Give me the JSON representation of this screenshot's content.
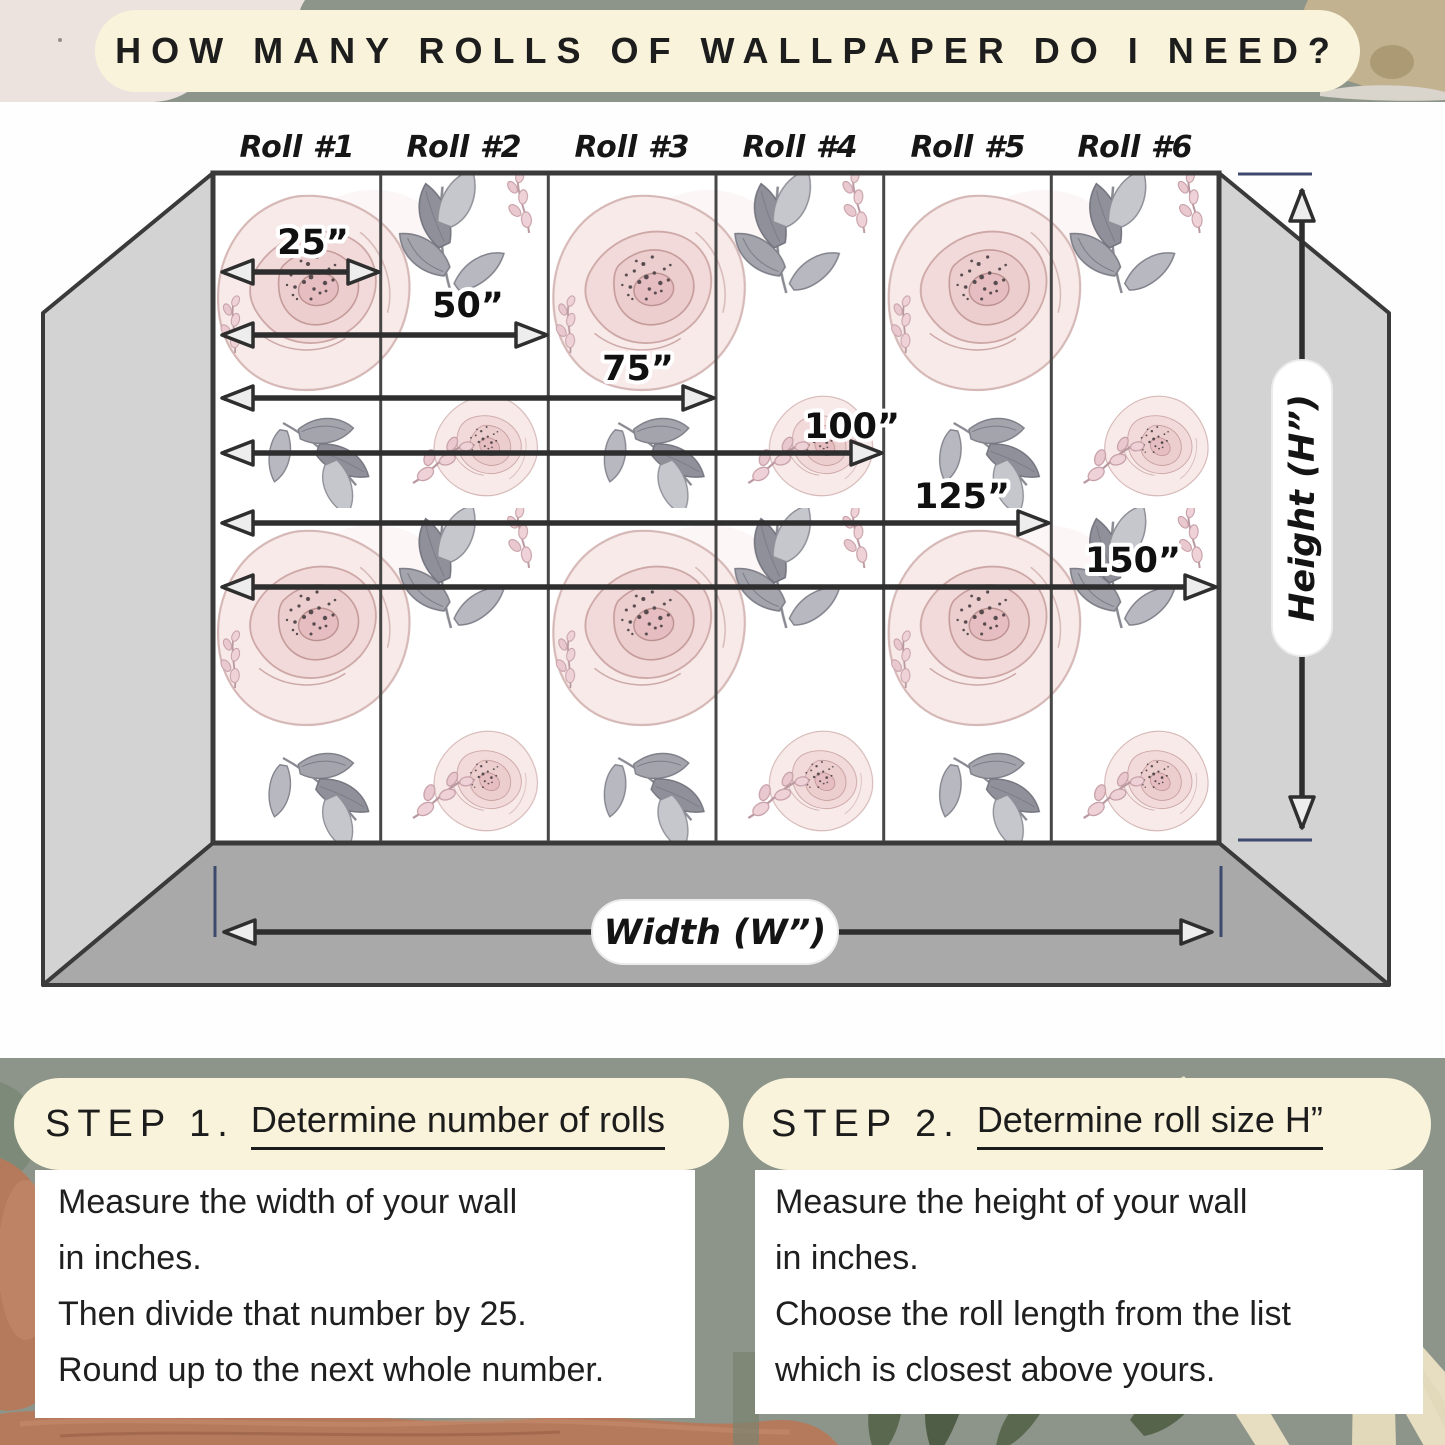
{
  "title": "HOW MANY ROLLS OF WALLPAPER DO I NEED?",
  "wall_diagram": {
    "roll_labels": [
      "Roll #1",
      "Roll #2",
      "Roll #3",
      "Roll #4",
      "Roll #5",
      "Roll #6"
    ],
    "width_measurements": [
      "25”",
      "50”",
      "75”",
      "100”",
      "125”",
      "150”"
    ],
    "height_label": "Height (H”)",
    "width_label": "Width (W”)"
  },
  "steps": [
    {
      "label": "STEP 1.",
      "heading": "Determine number of rolls",
      "lines": [
        "Measure the width of your wall",
        "in inches.",
        "Then divide that number by 25.",
        "Round up to the next whole number."
      ]
    },
    {
      "label": "STEP 2.",
      "heading": "Determine roll size H”",
      "lines": [
        "Measure the height of your wall",
        "in inches.",
        "Choose the roll length from the list",
        "which is closest above yours."
      ]
    }
  ],
  "colors": {
    "sage_green": "#8d958a",
    "cream": "#f8f3da",
    "ink": "#1d1d1d",
    "wall_gray": "#d3d3d3",
    "floor_gray": "#a9a9a9",
    "outline_dark": "#3a3a3a",
    "tick_navy": "#3d4a6e",
    "rust": "#b5795c",
    "olive_leaf": "#5a6850",
    "cream_frond": "#e7dec2",
    "blush_pink": "#f3dcdb"
  }
}
